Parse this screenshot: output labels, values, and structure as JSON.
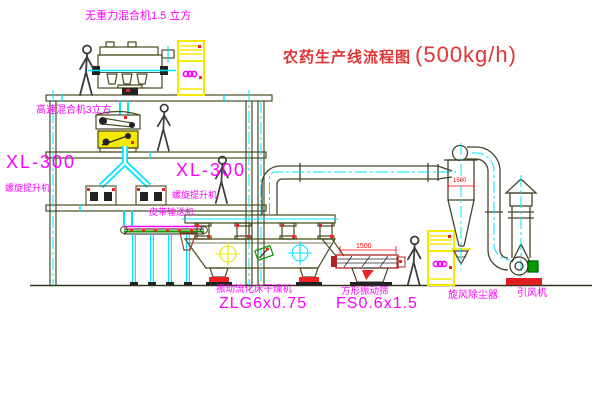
{
  "title": {
    "text": "农药生产线流程图",
    "capacity": "(500kg/h)"
  },
  "equipment": {
    "gravity_mixer": {
      "label": "无重力混合机1.5 立方"
    },
    "highspeed_mixer": {
      "label": "高速混合机3立方"
    },
    "elevator_left": {
      "model": "XL-300",
      "name": "螺旋提升机"
    },
    "elevator_mid": {
      "model": "XL-300",
      "name": "螺旋提升机"
    },
    "belt_conveyor": {
      "label": "皮带输送机"
    },
    "fluid_bed_dryer": {
      "name": "振动流化床干燥机",
      "model": "ZLG6x0.75"
    },
    "vibrating_screen": {
      "name": "方形振动筛",
      "model": "FS0.6x1.5",
      "dimension": "1500"
    },
    "cyclone": {
      "name": "旋风除尘器",
      "dimension": "1500"
    },
    "fan": {
      "name": "引风机"
    }
  },
  "colors": {
    "label_magenta": "#ff00ff",
    "title_red": "#cc3b3b",
    "dimension_red": "#ff0000",
    "centerline_cyan": "#00e5ff",
    "cabinet_yellow": "#f5e900",
    "machine_olive": "#4a4a20",
    "accent_green": "#00a000",
    "accent_red": "#ee2222"
  }
}
